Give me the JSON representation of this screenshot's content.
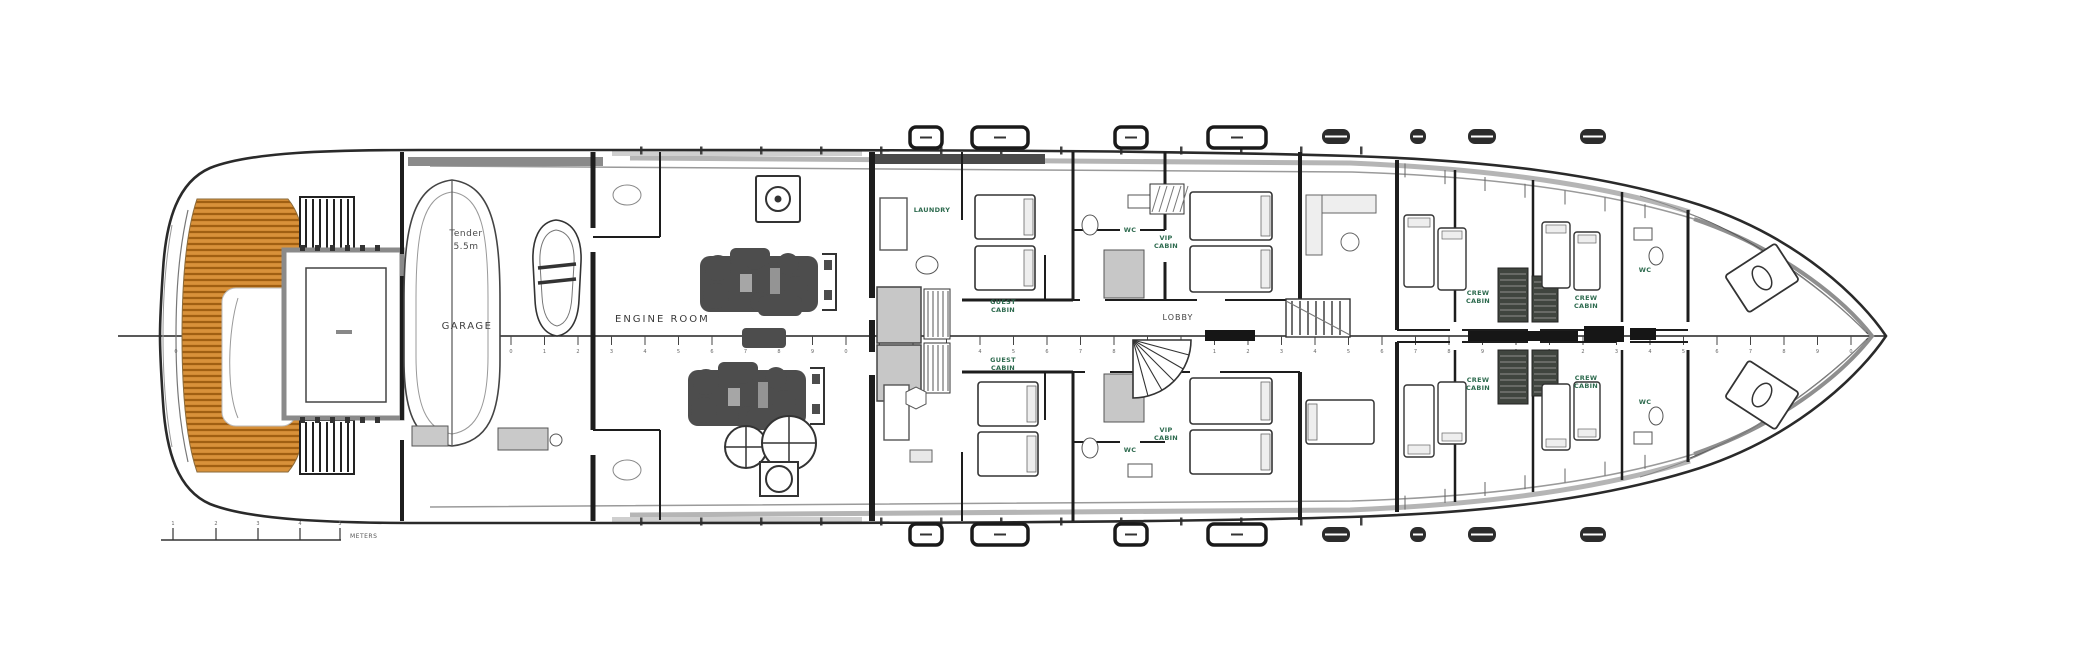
{
  "page": {
    "background": "#ffffff"
  },
  "colors": {
    "teak": "#d8913a",
    "teak_stripe": "#a05f12",
    "label_green": "#2e6b4f",
    "wall": "#1d1d1d",
    "fixture_gray": "#c7c7c7",
    "dark_block": "#40453f",
    "hull_line": "#2a2a2a"
  },
  "labels": {
    "tender": {
      "l1": "Tender",
      "l2": "5.5m"
    },
    "garage": "GARAGE",
    "engine_room": "ENGINE ROOM",
    "lobby": "LOBBY",
    "laundry": "LAUNDRY",
    "wc_guest_top": "WC",
    "wc_guest_bottom": "WC",
    "wc_crew_top": "WC",
    "wc_crew_bottom": "WC",
    "guest_cabin_top": {
      "l1": "GUEST",
      "l2": "CABIN"
    },
    "guest_cabin_bottom": {
      "l1": "GUEST",
      "l2": "CABIN"
    },
    "vip_cabin_top": {
      "l1": "VIP",
      "l2": "CABIN"
    },
    "vip_cabin_bottom": {
      "l1": "VIP",
      "l2": "CABIN"
    },
    "crew_cabin_1_top": {
      "l1": "CREW",
      "l2": "CABIN"
    },
    "crew_cabin_1_bottom": {
      "l1": "CREW",
      "l2": "CABIN"
    },
    "crew_cabin_2_top": {
      "l1": "CREW",
      "l2": "CABIN"
    },
    "crew_cabin_2_bottom": {
      "l1": "CREW",
      "l2": "CABIN"
    }
  },
  "scale_bar": {
    "units": "METERS",
    "tick_labels": [
      "1",
      "2",
      "3",
      "4",
      "5"
    ]
  }
}
